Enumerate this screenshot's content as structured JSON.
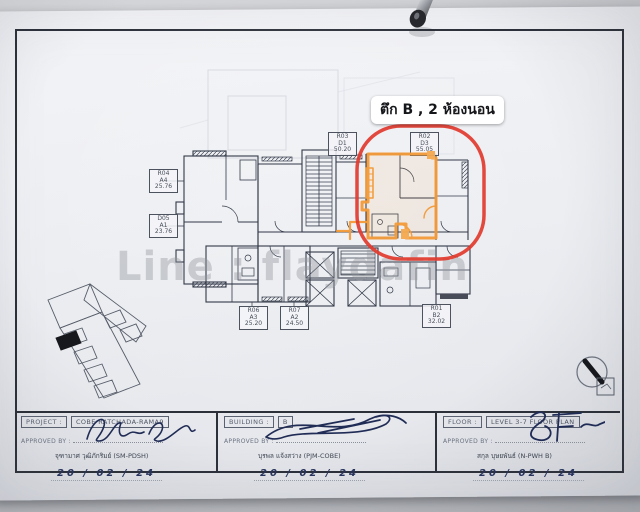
{
  "callout": {
    "text": "ตึก B , 2 ห้องนอน"
  },
  "watermark": "Line : flaydafin",
  "units": [
    {
      "code": "R04",
      "type": "A4",
      "area": "25.76"
    },
    {
      "code": "D05",
      "type": "A1",
      "area": "23.76"
    },
    {
      "code": "R03",
      "type": "D1",
      "area": "50.20"
    },
    {
      "code": "R02",
      "type": "D3",
      "area": "55.05"
    },
    {
      "code": "R06",
      "type": "A3",
      "area": "25.20"
    },
    {
      "code": "R07",
      "type": "A2",
      "area": "24.50"
    },
    {
      "code": "R01",
      "type": "B2",
      "area": "32.02"
    }
  ],
  "title_block": {
    "approved_label": "APPROVED BY :",
    "cells": [
      {
        "field": "PROJECT :",
        "value": "COBE RATCHADA-RAMA9",
        "name": "จุฑามาศ วุฒิภักริมย์ (SM-PDSH)",
        "date": "20 / 02 / 24"
      },
      {
        "field": "BUILDING :",
        "value": "B",
        "name": "บุรพล แจ้งสว่าง (PJM-COBE)",
        "date": "20 / 02 / 24"
      },
      {
        "field": "FLOOR :",
        "value": "LEVEL 3-7 FLOOR PLAN",
        "name": "สกุล บุษยพันธ์ (N-PWH B)",
        "date": "20 / 02 / 24"
      }
    ]
  },
  "colors": {
    "highlight_orange": "#f39a38",
    "circle_red": "#e23a2e",
    "ink_blue": "#202c55",
    "plan_line": "#333948"
  }
}
